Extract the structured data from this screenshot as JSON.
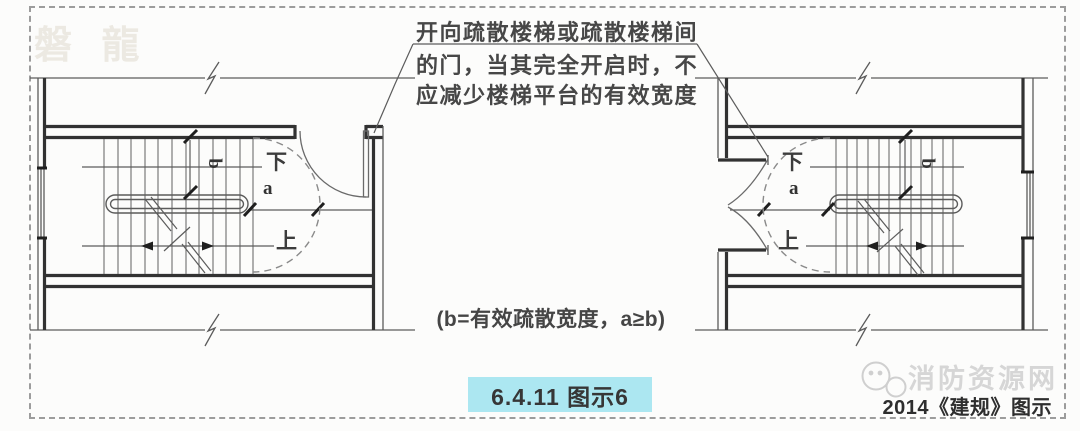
{
  "callout": {
    "line1": "开向疏散楼梯或疏散楼梯间",
    "line2": "的门，当其完全开启时，不",
    "line3": "应减少楼梯平台的有效宽度"
  },
  "plans": {
    "left": {
      "down_label": "下",
      "up_label": "上",
      "dim_a": "a",
      "dim_b": "b"
    },
    "right": {
      "down_label": "下",
      "up_label": "上",
      "dim_a": "a",
      "dim_b": "b"
    }
  },
  "note": "(b=有效疏散宽度，a≥b)",
  "figure_label": "6.4.11 图示6",
  "credit": "2014《建规》图示",
  "watermark_brand": "磐 龍",
  "watermark_site": "消防资源网",
  "colors": {
    "figure_band_bg": "#ace7f1",
    "linework": "#3a3a3a",
    "dashed_border": "#9c9c9c",
    "watermark_gray": "#d6d6d6"
  }
}
